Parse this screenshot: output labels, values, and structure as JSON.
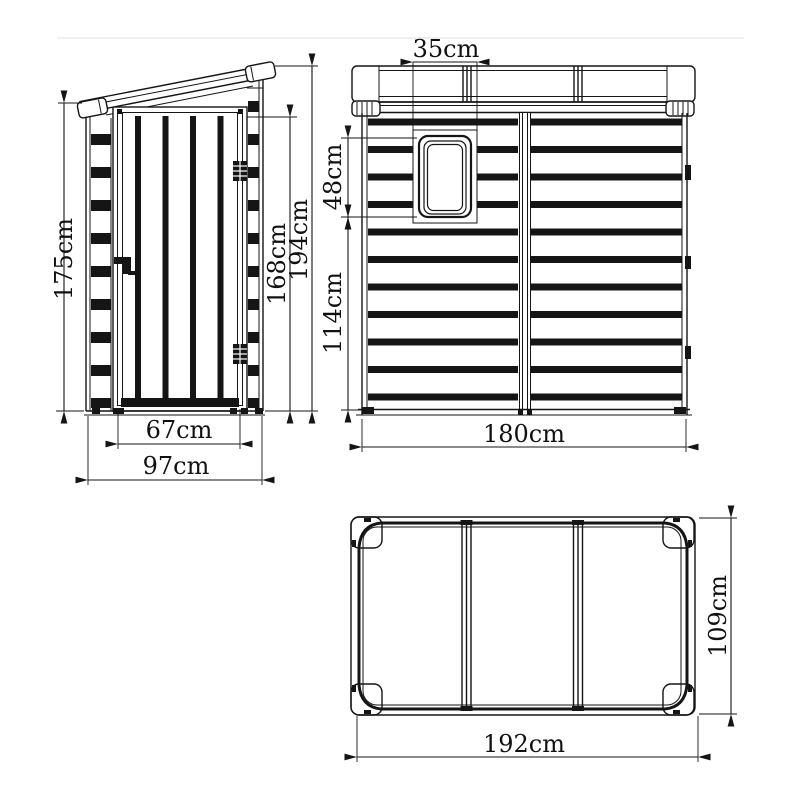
{
  "page": {
    "background": "#ffffff",
    "line_color": "#151515"
  },
  "drawing": {
    "unit": "cm",
    "views": {
      "side": {
        "dimensions": {
          "overall_height_front": "175cm",
          "door_height": "168cm",
          "overall_height_rear": "194cm",
          "door_width": "67cm",
          "overall_depth": "97cm"
        }
      },
      "front": {
        "dimensions": {
          "window_width": "35cm",
          "window_height": "48cm",
          "wall_below_window": "114cm",
          "overall_width": "180cm"
        }
      },
      "top": {
        "dimensions": {
          "roof_length": "192cm",
          "roof_depth": "109cm"
        }
      }
    }
  }
}
